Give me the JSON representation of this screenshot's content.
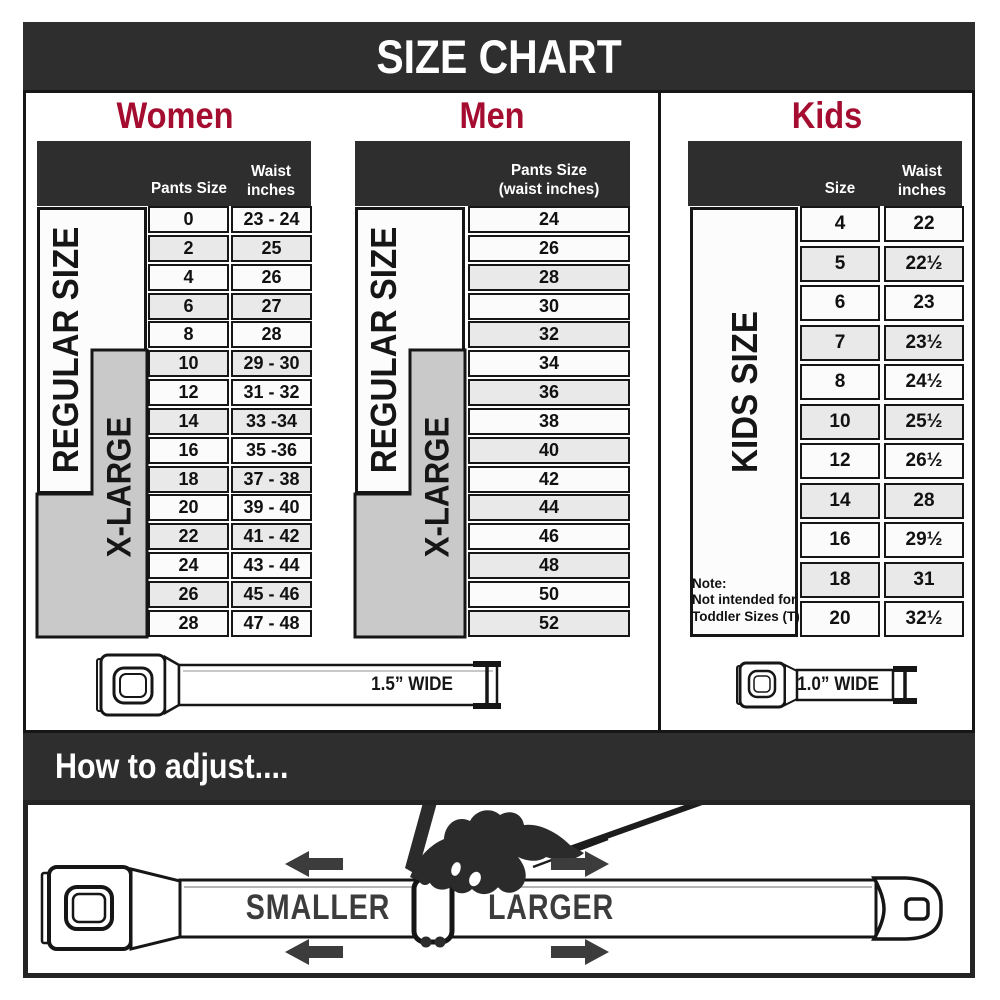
{
  "title": "SIZE CHART",
  "colors": {
    "bar_dark": "#2e2e2e",
    "accent_crimson": "#a50d30",
    "xlarge_gray": "#c9c9c9",
    "row_shaded": "#e9e9e9",
    "border_black": "#161616"
  },
  "sections": {
    "women": {
      "heading": "Women",
      "col1_header": "Pants Size",
      "col2_header_line1": "Waist",
      "col2_header_line2": "inches",
      "regular_label": "REGULAR SIZE",
      "xlarge_label": "X-LARGE",
      "rows": [
        {
          "size": "0",
          "waist": "23 - 24"
        },
        {
          "size": "2",
          "waist": "25"
        },
        {
          "size": "4",
          "waist": "26"
        },
        {
          "size": "6",
          "waist": "27"
        },
        {
          "size": "8",
          "waist": "28"
        },
        {
          "size": "10",
          "waist": "29 - 30"
        },
        {
          "size": "12",
          "waist": "31 - 32"
        },
        {
          "size": "14",
          "waist": "33 -34"
        },
        {
          "size": "16",
          "waist": "35 -36"
        },
        {
          "size": "18",
          "waist": "37 - 38"
        },
        {
          "size": "20",
          "waist": "39 - 40"
        },
        {
          "size": "22",
          "waist": "41 - 42"
        },
        {
          "size": "24",
          "waist": "43 - 44"
        },
        {
          "size": "26",
          "waist": "45 - 46"
        },
        {
          "size": "28",
          "waist": "47 - 48"
        }
      ]
    },
    "men": {
      "heading": "Men",
      "col_header_line1": "Pants Size",
      "col_header_line2": "(waist inches)",
      "regular_label": "REGULAR SIZE",
      "xlarge_label": "X-LARGE",
      "rows": [
        "24",
        "26",
        "28",
        "30",
        "32",
        "34",
        "36",
        "38",
        "40",
        "42",
        "44",
        "46",
        "48",
        "50",
        "52"
      ]
    },
    "kids": {
      "heading": "Kids",
      "col1_header": "Size",
      "col2_header_line1": "Waist",
      "col2_header_line2": "inches",
      "label": "KIDS SIZE",
      "note_line1": "Note:",
      "note_line2": "Not intended for",
      "note_line3": "Toddler Sizes (T)",
      "rows": [
        {
          "size": "4",
          "waist": "22"
        },
        {
          "size": "5",
          "waist": "22½"
        },
        {
          "size": "6",
          "waist": "23"
        },
        {
          "size": "7",
          "waist": "23½"
        },
        {
          "size": "8",
          "waist": "24½"
        },
        {
          "size": "10",
          "waist": "25½"
        },
        {
          "size": "12",
          "waist": "26½"
        },
        {
          "size": "14",
          "waist": "28"
        },
        {
          "size": "16",
          "waist": "29½"
        },
        {
          "size": "18",
          "waist": "31"
        },
        {
          "size": "20",
          "waist": "32½"
        }
      ]
    }
  },
  "belts": {
    "adult_width_label": "1.5” WIDE",
    "kids_width_label": "1.0” WIDE"
  },
  "howto": {
    "heading": "How to adjust....",
    "smaller_label": "SMALLER",
    "larger_label": "LARGER"
  }
}
